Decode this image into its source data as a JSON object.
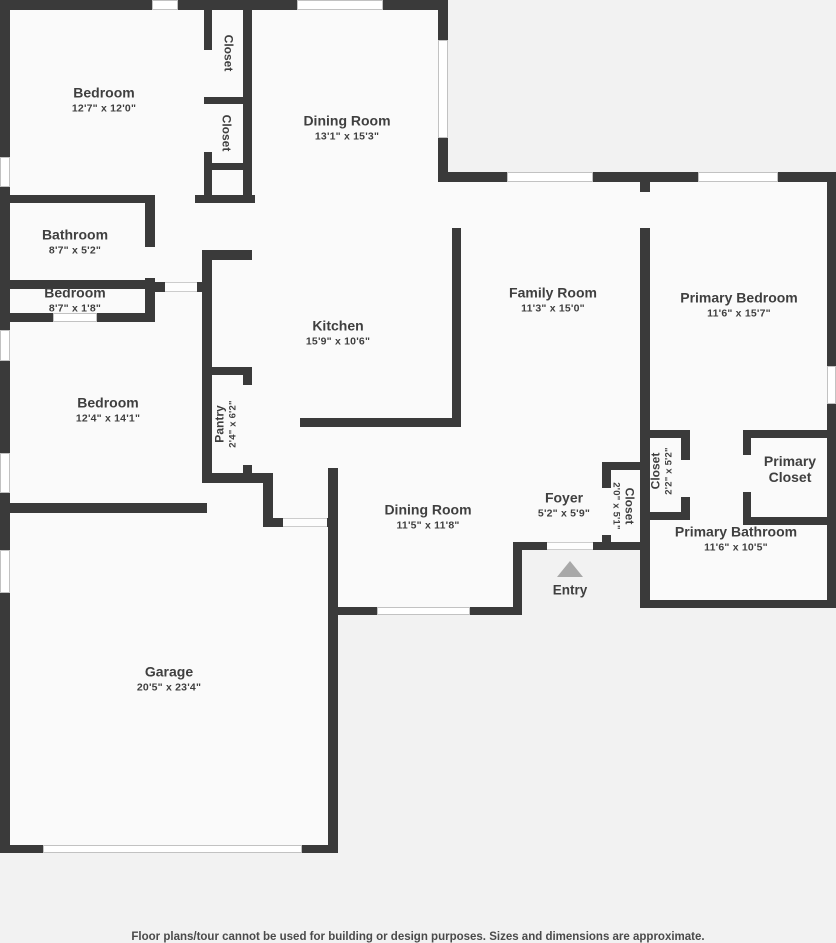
{
  "rooms": {
    "bedroom_top": {
      "name": "Bedroom",
      "dims": "12'7\" x 12'0\""
    },
    "closet_top_1": {
      "name": "Closet"
    },
    "closet_top_2": {
      "name": "Closet"
    },
    "dining_top": {
      "name": "Dining Room",
      "dims": "13'1\" x 15'3\""
    },
    "bathroom": {
      "name": "Bathroom",
      "dims": "8'7\" x 5'2\""
    },
    "bedroom_mid": {
      "name": "Bedroom",
      "dims": "8'7\" x 1'8\""
    },
    "bedroom_left": {
      "name": "Bedroom",
      "dims": "12'4\" x 14'1\""
    },
    "kitchen": {
      "name": "Kitchen",
      "dims": "15'9\" x 10'6\""
    },
    "family_room": {
      "name": "Family Room",
      "dims": "11'3\" x 15'0\""
    },
    "primary_bedroom": {
      "name": "Primary Bedroom",
      "dims": "11'6\" x 15'7\""
    },
    "pantry": {
      "name": "Pantry",
      "dims": "2'4\" x 6'2\""
    },
    "dining_lower": {
      "name": "Dining Room",
      "dims": "11'5\" x 11'8\""
    },
    "foyer": {
      "name": "Foyer",
      "dims": "5'2\" x 5'9\""
    },
    "closet_foyer": {
      "name": "Closet",
      "dims": "2'0\" x 5'1\""
    },
    "closet_hall": {
      "name": "Closet",
      "dims": "2'2\" x 5'2\""
    },
    "primary_closet": {
      "name": "Primary Closet"
    },
    "primary_bathroom": {
      "name": "Primary Bathroom",
      "dims": "11'6\" x 10'5\""
    },
    "garage": {
      "name": "Garage",
      "dims": "20'5\" x 23'4\""
    }
  },
  "entry_label": "Entry",
  "footer_note": "Floor plans/tour cannot be used for building or design purposes. Sizes and dimensions are approximate.",
  "colors": {
    "wall": "#3a3a3a",
    "interior": "#fafafa",
    "exterior": "#f2f2f2",
    "window_border": "#c2c2c2",
    "label_text": "#3f3f3f",
    "entry_arrow": "#a8a8a8"
  }
}
